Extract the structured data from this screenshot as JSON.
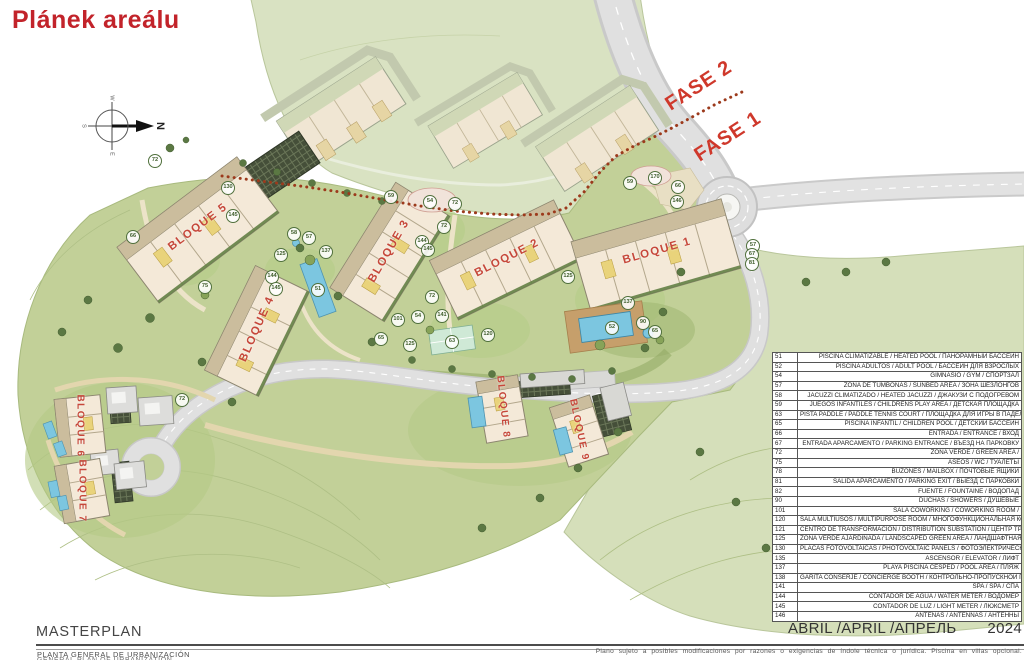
{
  "page": {
    "title": "Plánek areálu"
  },
  "map": {
    "fase1": "FASE 1",
    "fase2": "FASE 2",
    "compass": {
      "n": "N",
      "s": "S",
      "e": "E",
      "w": "W"
    },
    "blocks": [
      {
        "label": "BLOQUE 1",
        "x": 657,
        "y": 251,
        "rot": -16,
        "fs": 11.5
      },
      {
        "label": "BLOQUE 2",
        "x": 507,
        "y": 258,
        "rot": -27,
        "fs": 11.5
      },
      {
        "label": "BLOQUE 3",
        "x": 389,
        "y": 251,
        "rot": -60,
        "fs": 11.5
      },
      {
        "label": "BLOQUE 4",
        "x": 257,
        "y": 329,
        "rot": -66,
        "fs": 11.5
      },
      {
        "label": "BLOQUE 5",
        "x": 198,
        "y": 227,
        "rot": -37,
        "fs": 11.5
      },
      {
        "label": "BLOQUE 6",
        "x": 80,
        "y": 426,
        "rot": 90,
        "fs": 10
      },
      {
        "label": "BLOQUE 7",
        "x": 82,
        "y": 491,
        "rot": 90,
        "fs": 10
      },
      {
        "label": "BLOQUE 8",
        "x": 503,
        "y": 407,
        "rot": 84,
        "fs": 10
      },
      {
        "label": "BLOQUE 9",
        "x": 579,
        "y": 430,
        "rot": 78,
        "fs": 10
      }
    ],
    "badges": [
      {
        "n": "130",
        "x": 228,
        "y": 188
      },
      {
        "n": "145",
        "x": 233,
        "y": 216
      },
      {
        "n": "72",
        "x": 155,
        "y": 161
      },
      {
        "n": "66",
        "x": 133,
        "y": 237
      },
      {
        "n": "58",
        "x": 294,
        "y": 234
      },
      {
        "n": "57",
        "x": 309,
        "y": 238
      },
      {
        "n": "125",
        "x": 281,
        "y": 255
      },
      {
        "n": "144",
        "x": 272,
        "y": 277
      },
      {
        "n": "145",
        "x": 276,
        "y": 289
      },
      {
        "n": "75",
        "x": 205,
        "y": 287
      },
      {
        "n": "51",
        "x": 318,
        "y": 290
      },
      {
        "n": "137",
        "x": 326,
        "y": 252
      },
      {
        "n": "59",
        "x": 391,
        "y": 197
      },
      {
        "n": "54",
        "x": 430,
        "y": 202
      },
      {
        "n": "72",
        "x": 455,
        "y": 204
      },
      {
        "n": "72",
        "x": 444,
        "y": 227
      },
      {
        "n": "144",
        "x": 422,
        "y": 242
      },
      {
        "n": "145",
        "x": 428,
        "y": 250
      },
      {
        "n": "72",
        "x": 432,
        "y": 297
      },
      {
        "n": "101",
        "x": 398,
        "y": 320
      },
      {
        "n": "54",
        "x": 418,
        "y": 317
      },
      {
        "n": "141",
        "x": 442,
        "y": 316
      },
      {
        "n": "65",
        "x": 381,
        "y": 339
      },
      {
        "n": "125",
        "x": 410,
        "y": 345
      },
      {
        "n": "63",
        "x": 452,
        "y": 342
      },
      {
        "n": "120",
        "x": 488,
        "y": 335
      },
      {
        "n": "170",
        "x": 655,
        "y": 178
      },
      {
        "n": "59",
        "x": 630,
        "y": 183
      },
      {
        "n": "66",
        "x": 678,
        "y": 187
      },
      {
        "n": "146",
        "x": 677,
        "y": 202
      },
      {
        "n": "125",
        "x": 568,
        "y": 277
      },
      {
        "n": "137",
        "x": 628,
        "y": 303
      },
      {
        "n": "52",
        "x": 612,
        "y": 328
      },
      {
        "n": "90",
        "x": 643,
        "y": 323
      },
      {
        "n": "65",
        "x": 655,
        "y": 332
      },
      {
        "n": "57",
        "x": 753,
        "y": 246
      },
      {
        "n": "67",
        "x": 752,
        "y": 255
      },
      {
        "n": "81",
        "x": 752,
        "y": 264
      },
      {
        "n": "72",
        "x": 182,
        "y": 400
      }
    ]
  },
  "legend": {
    "rows": [
      {
        "num": "51",
        "text": "PISCINA CLIMATIZABLE / HEATED POOL / ПАНОРАМНЫЙ БАССЕЙН"
      },
      {
        "num": "52",
        "text": "PISCINA ADULTOS / ADULT POOL / БАССЕЙН ДЛЯ ВЗРОСЛЫХ"
      },
      {
        "num": "54",
        "text": "GIMNASIO / GYM / СПОРТЗАЛ"
      },
      {
        "num": "57",
        "text": "ZONA DE TUMBONAS / SUNBED AREA / ЗОНА ШЕЗЛОНГОВ"
      },
      {
        "num": "58",
        "text": "JACUZZI CLIMATIZADO / HEATED JACUZZI / ДЖАКУЗИ С ПОДОГРЕВОМ"
      },
      {
        "num": "59",
        "text": "JUEGOS INFANTILES / CHILDRENS PLAY AREA / ДЕТСКАЯ ПЛОЩАДКА"
      },
      {
        "num": "63",
        "text": "PISTA PADDLE / PADDLE TENNIS COURT / ПЛОЩАДКА ДЛЯ ИГРЫ В ПАДЕЛ-ТЕННИС"
      },
      {
        "num": "65",
        "text": "PISCINA INFANTIL / CHILDREN POOL / ДЕТСКИЙ БАССЕЙН"
      },
      {
        "num": "66",
        "text": "ENTRADA / ENTRANCE / ВХОД"
      },
      {
        "num": "67",
        "text": "ENTRADA APARCAMENTO / PARKING ENTRANCE / ВЪЕЗД НА ПАРКОВКУ"
      },
      {
        "num": "72",
        "text": "ZONA VERDE / GREEN AREA /"
      },
      {
        "num": "75",
        "text": "ASEOS / WC / ТУАЛЕТЫ"
      },
      {
        "num": "78",
        "text": "BUZONES / MAILBOX / ПОЧТОВЫЕ ЯЩИКИ"
      },
      {
        "num": "81",
        "text": "SALIDA APARCAMENTO / PARKING EXIT / ВЫЕЗД С ПАРКОВКИ"
      },
      {
        "num": "82",
        "text": "FUENTE / FOUNTAINE / ВОДОПАД"
      },
      {
        "num": "90",
        "text": "DUCHAS / SHOWERS / ДУШЕВЫЕ"
      },
      {
        "num": "101",
        "text": "SALA COWORKING / COWORKING ROOM /"
      },
      {
        "num": "120",
        "text": "SALA MULTIUSOS / MULTIPURPOSE ROOM / МНОГОФУНКЦИОНАЛЬНАЯ КОМНАТА"
      },
      {
        "num": "121",
        "text": "CENTRO DE TRANSFORMACIÓN / DISTRIBUTION SUBSTATION / ЦЕНТР ТРАНСФОРМАЦИИ"
      },
      {
        "num": "125",
        "text": "ZONA VERDE AJARDINADA / LANDSCAPED GREEN AREA / ЛАНДШАФТНАЯ ЗЕЛЕНАЯ ЗОНА"
      },
      {
        "num": "130",
        "text": "PLACAS FOTOVOLTAICAS / PHOTOVOLTAIC PANELS / ФОТОЭЛЕКТРИЧЕСКИЕ ПАНЕЛИ"
      },
      {
        "num": "135",
        "text": "ASCENSOR / ELEVATOR / ЛИФТ"
      },
      {
        "num": "137",
        "text": "PLAYA PISCINA CESPED / POOL AREA / ПЛЯЖ"
      },
      {
        "num": "138",
        "text": "GARITA CONSERJE / CONCIERGE BOOTH / КОНТРОЛЬНО-ПРОПУСКНОЙ ПУНКТ"
      },
      {
        "num": "141",
        "text": "SPA / SPA / СПА"
      },
      {
        "num": "144",
        "text": "CONTADOR DE AGUA / WATER METER / ВОДОМЕР"
      },
      {
        "num": "145",
        "text": "CONTADOR DE LUZ / LIGHT METER / ЛЮКСМЕТР"
      },
      {
        "num": "146",
        "text": "ANTENAS / ANTENNAS / АНТЕННЫ"
      }
    ]
  },
  "footer": {
    "date_label": "ABRIL /APRIL /АПРЕЛЬ",
    "date_year": "2024",
    "masterplan": "MASTERPLAN",
    "subtitle_es": "PLANTA GENERAL DE URBANIZACIÓN",
    "subtitle_en": "GENERAL PLAN OF URBANIZATION",
    "disclaimer": "Plano sujeto a posibles modificaciones por razones o exigencias de índole técnica o jurídica. Piscina en villas opcional."
  },
  "colors": {
    "accent_red": "#c2232a",
    "site_green": "#c2d098",
    "phase2_green": "#d9e2c2",
    "road_gray": "#e0e0e0",
    "pool_blue": "#7cc6e0"
  }
}
